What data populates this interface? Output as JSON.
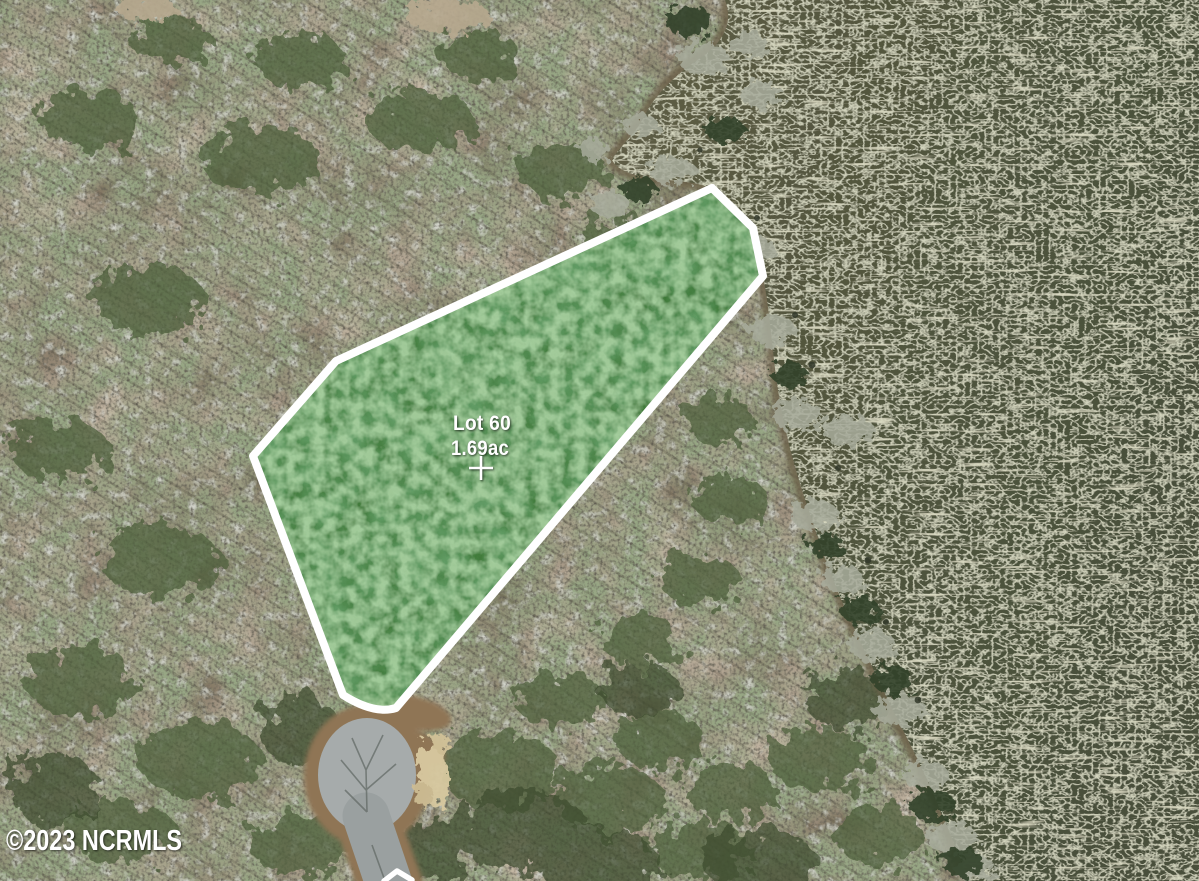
{
  "map": {
    "view": "satellite-aerial",
    "watermark": "©2023 NCRMLS",
    "parcel": {
      "label": "Lot 60",
      "area_label": "1.69ac",
      "marker": "crosshair-icon"
    },
    "scene": {
      "water_body": "lake",
      "road": "cul-de-sac",
      "terrain": "wooded-lot"
    }
  },
  "colors": {
    "parcel_fill": "#3e7a37",
    "parcel_outline": "#ffffff",
    "label_text": "#ffffff",
    "water_near": "#5e5c45",
    "water_far": "#49503a",
    "forest_base": "#7d705c",
    "forest_canopy": "#4d5f3a",
    "bare_trees": "#a8ac9c",
    "pavement": "#a6abab",
    "dirt": "#8f7454",
    "sand": "#d8c9a0"
  }
}
